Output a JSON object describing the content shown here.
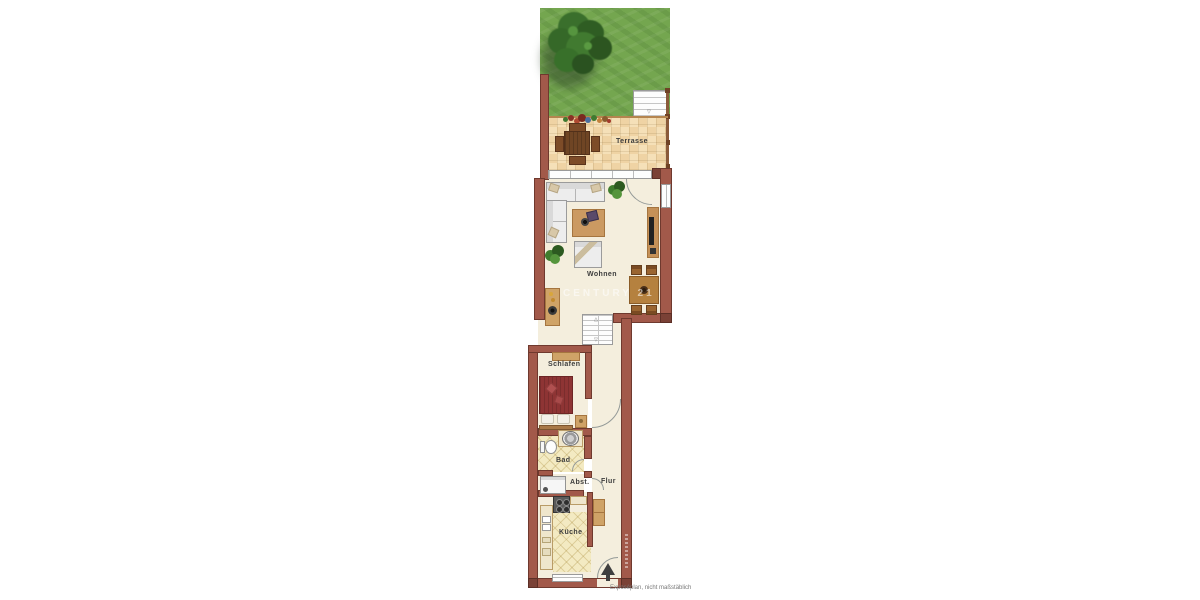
{
  "labels": {
    "terrasse": "Terrasse",
    "wohnen": "Wohnen",
    "schlafen": "Schlafen",
    "bad": "Bad",
    "abst": "Abst.",
    "flur": "Flur",
    "kueche": "Küche"
  },
  "watermark": "CENTURY 21",
  "disclaimer": "Exposéplan, nicht maßstäblich",
  "icons": {
    "stair_direction_arrow": "▽"
  },
  "colors": {
    "wall": "#a2594a",
    "wall_dark": "#7a4136",
    "floor": "#f4eedd",
    "terrace_tile": "#f2d9ae",
    "grass": "#74a64f",
    "bath_tile": "#f3eac2",
    "wood": "#cfa367",
    "bed_cover": "#8e3434"
  }
}
